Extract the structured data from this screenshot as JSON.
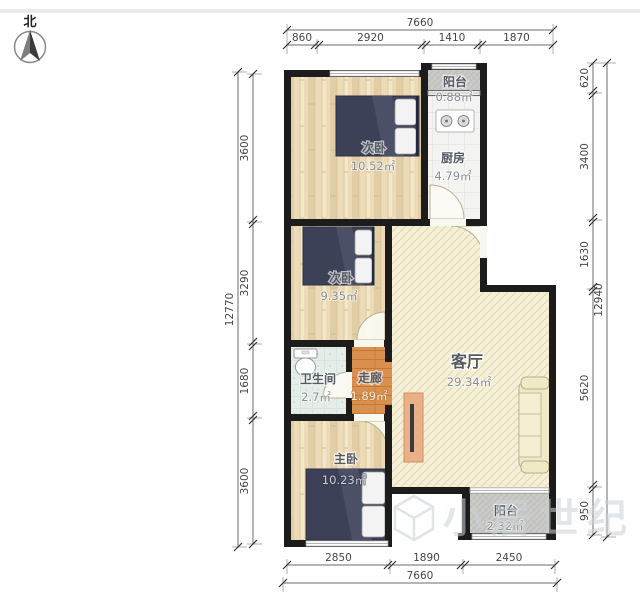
{
  "compass": {
    "label": "北"
  },
  "rooms": {
    "bedroom_top": {
      "name": "次卧",
      "area": "10.52㎡"
    },
    "balcony_top": {
      "name": "阳台",
      "area": "0.88㎡"
    },
    "kitchen": {
      "name": "厨房",
      "area": "4.79㎡"
    },
    "bedroom_mid": {
      "name": "次卧",
      "area": "9.35㎡"
    },
    "bathroom": {
      "name": "卫生间",
      "area": "2.7㎡"
    },
    "corridor": {
      "name": "走廊",
      "area": "1.89㎡"
    },
    "living": {
      "name": "客厅",
      "area": "29.34㎡"
    },
    "bedroom_master": {
      "name": "主卧",
      "area": "10.23㎡"
    },
    "balcony_bottom": {
      "name": "阳台",
      "area": "2.32㎡"
    }
  },
  "dimensions": {
    "top": {
      "total": "7660",
      "segments": [
        "860",
        "2920",
        "1410",
        "1870"
      ]
    },
    "bottom": {
      "total": "7660",
      "segments": [
        "2850",
        "1890",
        "2450"
      ]
    },
    "left": {
      "total": "12770",
      "segments": [
        "3600",
        "3290",
        "1680",
        "3600"
      ]
    },
    "right": {
      "total": "12940",
      "segments": [
        "620",
        "3400",
        "1630",
        "5620",
        "950"
      ]
    }
  },
  "watermark": {
    "text": "小居世纪"
  },
  "colors": {
    "wall": "#1c1c1c",
    "wood_floor": "#ecdbb6",
    "living_floor": "#f5efd6",
    "balcony_floor": "#c9c9c5",
    "corridor_floor": "#d9904e",
    "kitchen_floor": "#f3f4f2",
    "bathroom_floor": "#e4ede8",
    "bed": "#3c4157"
  }
}
